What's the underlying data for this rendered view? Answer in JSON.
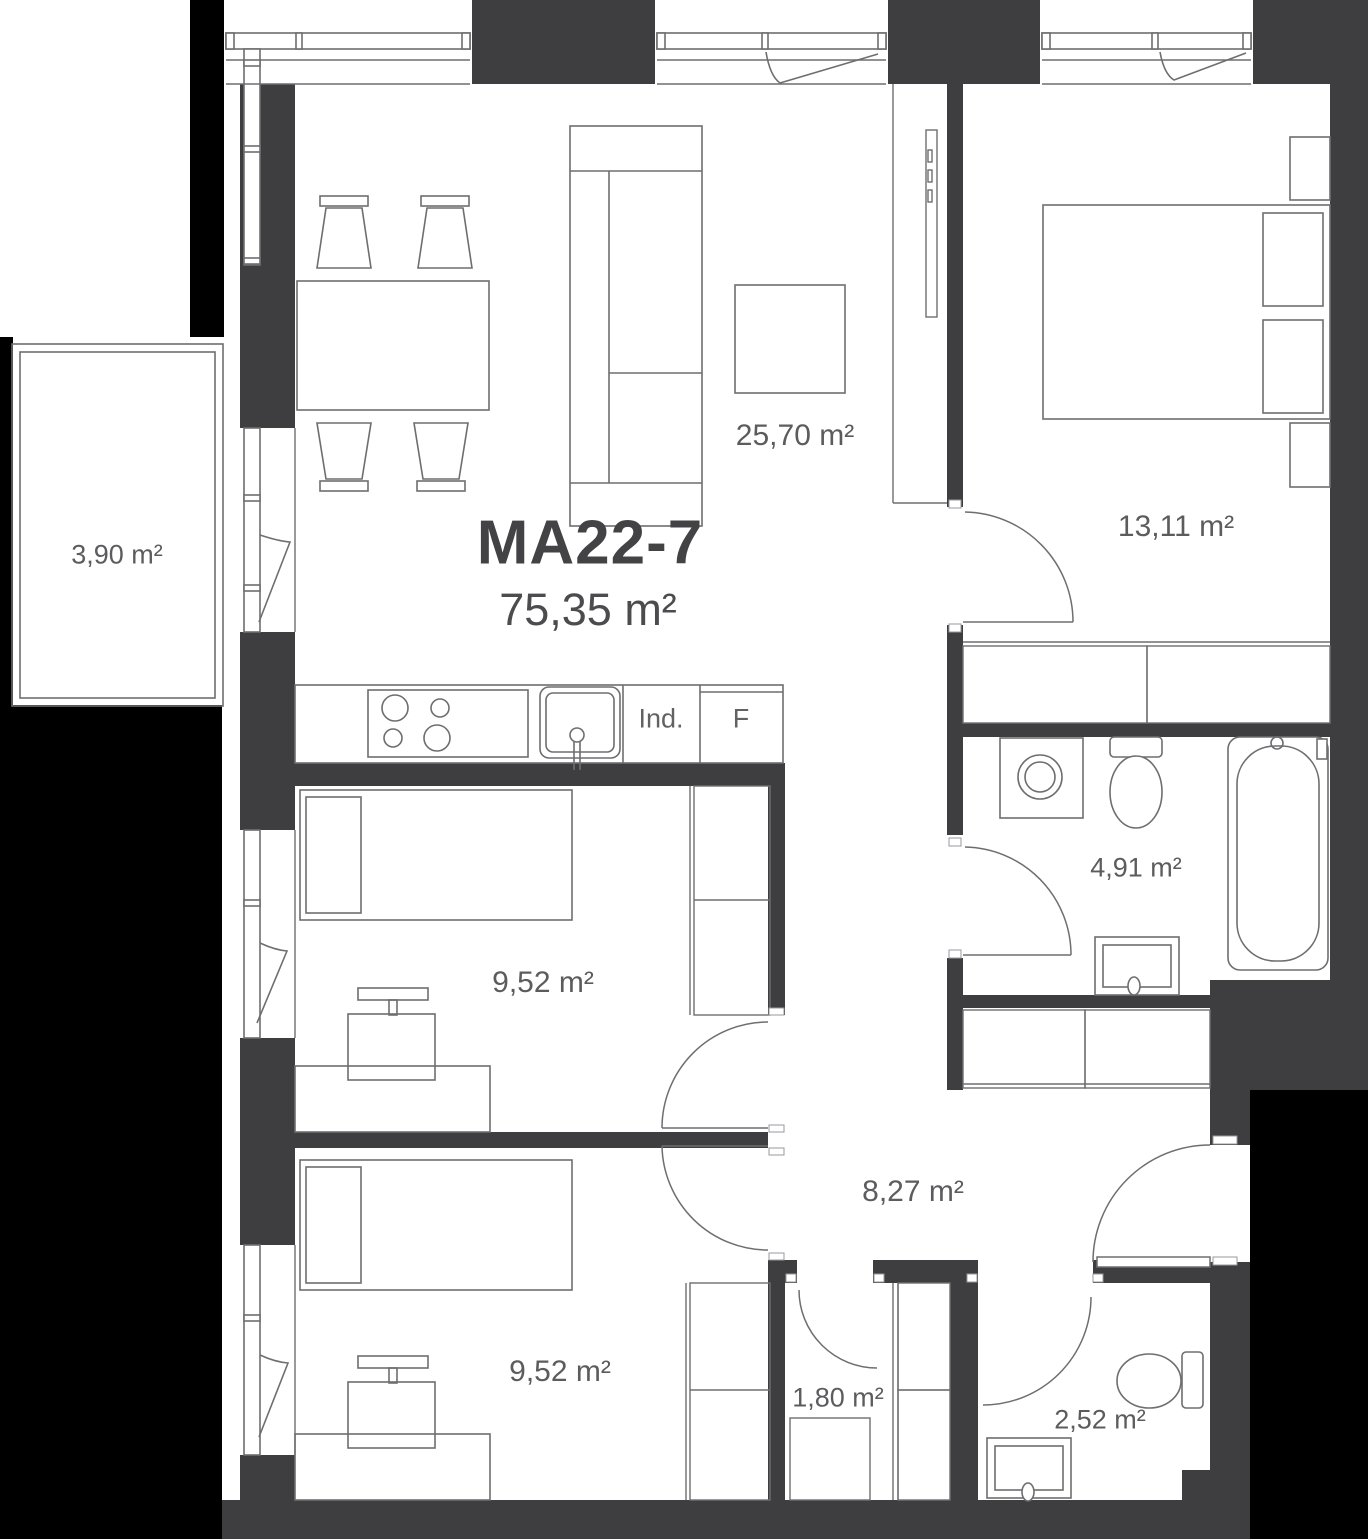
{
  "plan": {
    "title": "MA22-7",
    "total_area": "75,35 m²",
    "rooms": [
      {
        "id": "living-room",
        "label": "25,70 m²"
      },
      {
        "id": "bedroom",
        "label": "13,11 m²"
      },
      {
        "id": "balcony",
        "label": "3,90 m²"
      },
      {
        "id": "bathroom",
        "label": "4,91 m²"
      },
      {
        "id": "child-room-1",
        "label": "9,52 m²"
      },
      {
        "id": "child-room-2",
        "label": "9,52 m²"
      },
      {
        "id": "hallway",
        "label": "8,27 m²"
      },
      {
        "id": "storage",
        "label": "1,80 m²"
      },
      {
        "id": "wc",
        "label": "2,52 m²"
      }
    ],
    "kitchen": {
      "induction_label": "Ind.",
      "fridge_label": "F"
    },
    "colors": {
      "wall": "#3e3e41",
      "outline": "#6e6e70",
      "text": "#5c5c5e",
      "void": "#000000"
    }
  }
}
